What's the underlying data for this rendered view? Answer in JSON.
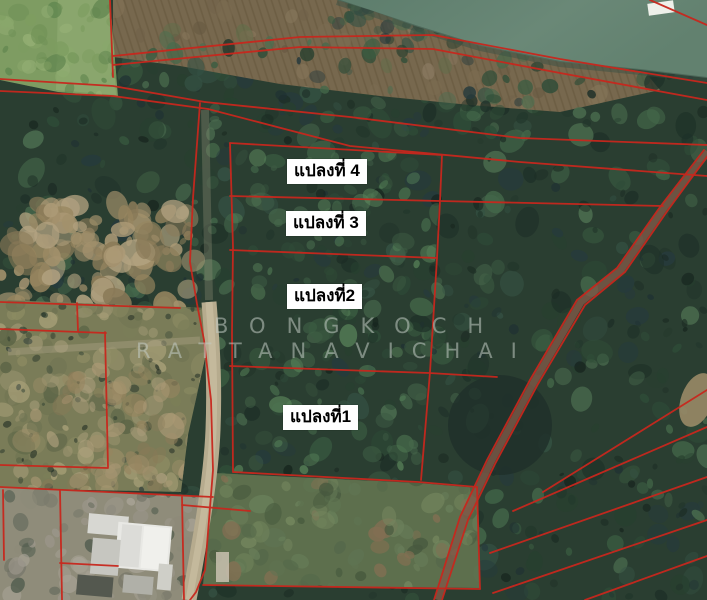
{
  "map": {
    "description": "Satellite land-plot map with red cadastral parcel boundary overlay",
    "plots": [
      {
        "label": "แปลงที่ 4"
      },
      {
        "label": "แปลงที่ 3"
      },
      {
        "label": "แปลงที่2"
      },
      {
        "label": "แปลงที่1"
      }
    ],
    "watermark": {
      "line1": "BONGKOCH",
      "line2": "RATTANAVICHAI"
    },
    "colors": {
      "parcel_line": "#c8271d",
      "label_bg": "#ffffff",
      "label_text": "#000000",
      "watermark": "#c2cbc4",
      "water": "#64836f",
      "forest": "#2a3e31"
    }
  }
}
